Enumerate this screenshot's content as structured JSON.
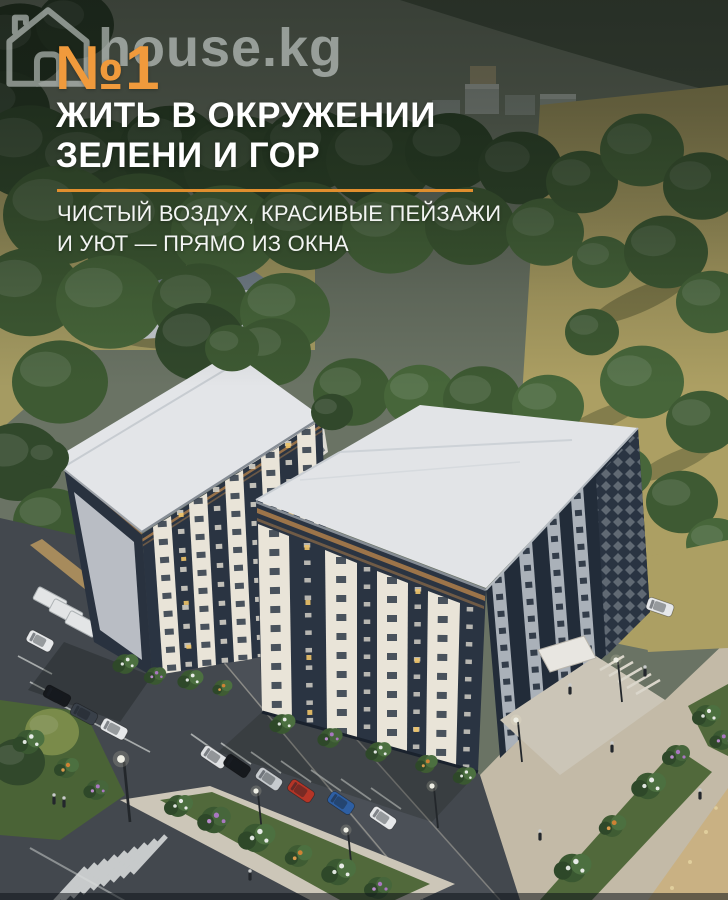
{
  "watermark": {
    "text": "house.kg",
    "icon": "house-outline-icon",
    "color": "rgba(226,233,231,0.55)"
  },
  "copy": {
    "rank": "№1",
    "headline_line1": "ЖИТЬ В ОКРУЖЕНИИ",
    "headline_line2": "ЗЕЛЕНИ И ГОР",
    "subtitle_line1": "ЧИСТЫЙ ВОЗДУХ, КРАСИВЫЕ ПЕЙЗАЖИ",
    "subtitle_line2": "И УЮТ — ПРЯМО ИЗ ОКНА"
  },
  "colors": {
    "accent_orange": "#F09A3C",
    "divider_orange": "#E08E2E",
    "headline_white": "#FFFFFF",
    "top_overlay": "rgba(13,18,15,0.5)",
    "building_navy": "#2A3442",
    "roof_white": "#E3E5E8",
    "facade_cream": "#E9E4D8",
    "bronze_trim": "#A97B4A",
    "forest_green": "#3A5530",
    "lawn_olive": "#A59B62",
    "asphalt_gray": "#43484E",
    "pavement_beige": "#C3BAA7"
  }
}
